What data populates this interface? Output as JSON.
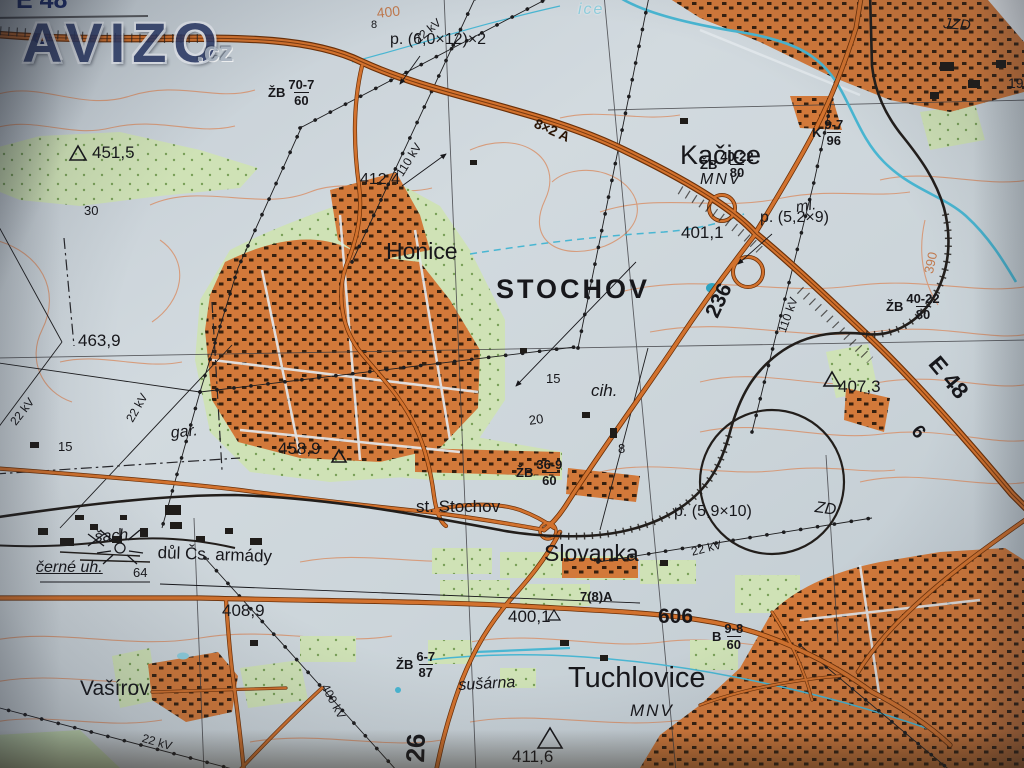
{
  "watermark": {
    "brand": "AVIZO",
    "tld": ".cz"
  },
  "places": {
    "kacice": "Kačice",
    "kacice_sub": "MNV",
    "honice": "Honice",
    "stochov": "STOCHOV",
    "st_stochov": "st. Stochov",
    "slovanka": "Slovanka",
    "tuchlovice": "Tuchlovice",
    "tuchlovice_sub": "MNV",
    "vasirov": "Vašírov"
  },
  "features": {
    "jzd": "JZD",
    "zd": "ZD",
    "ml": "ml.",
    "gar": "gar.",
    "cih": "cih.",
    "sach": "šach.",
    "dul": "důl Čs. armády",
    "cerne_uh": "černé uh.",
    "susarna": "sušárna",
    "stream_name": "ice"
  },
  "heights": {
    "h451_5": "451,5",
    "h412_4": "412,4",
    "h463_9": "463,9",
    "h458_9": "458,9",
    "h407_3": "407,3",
    "h401_1": "401,1",
    "h408_9": "408,9",
    "h400_1": "400,1",
    "h411_6": "411,6"
  },
  "roads": {
    "e48_tl": "E 48",
    "n6_tl": "6",
    "e48_r": "E 48",
    "n6_r": "6",
    "r236": "236",
    "r606": "606",
    "r26": "26",
    "r78a": "7(8)A",
    "lanes": "8×2 A"
  },
  "power": {
    "kv22": "22 kV",
    "kv110": "110 kV",
    "kv400": "400 kV"
  },
  "bridges": {
    "b1": {
      "pre": "ŽB",
      "num": "70-7",
      "den": "60"
    },
    "b2": {
      "pre": "ŽB",
      "num": "40-22",
      "den": "80"
    },
    "b3": {
      "pre": "ŽB",
      "num": "40-22",
      "den": "80"
    },
    "b4": {
      "pre": "ŽB",
      "num": "36-9",
      "den": "60"
    },
    "b5": {
      "pre": "ŽB",
      "num": "6-7",
      "den": "87"
    },
    "b6": {
      "pre": "B",
      "num": "9-8",
      "den": "60"
    },
    "b7": {
      "pre": "K",
      "num": "9-7",
      "den": "96"
    }
  },
  "underpasses": {
    "p1": "p. (6,0×12)×2",
    "p2": "p. (5,2×9)",
    "p3": "p. (5,9×10)"
  },
  "contour_labels": {
    "c400": "400",
    "c390": "390"
  },
  "numbers": {
    "n30": "30",
    "n15a": "15",
    "n15b": "15",
    "n20": "20",
    "n8a": "8",
    "n8b": "8",
    "n64": "64",
    "n19": "19"
  }
}
